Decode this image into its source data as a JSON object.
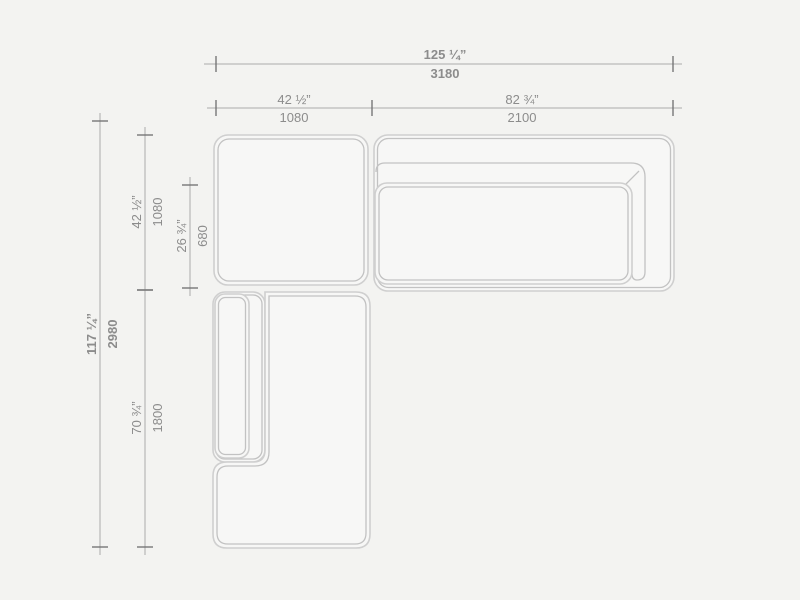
{
  "colors": {
    "background": "#f3f3f1",
    "shape_fill": "#f7f7f6",
    "outline_outer": "#cfcfcf",
    "outline_inner": "#c2c2c2",
    "dim_line": "#ababab",
    "dim_tick": "#6e6e6e",
    "dim_text": "#8c8c8c"
  },
  "dimensions": {
    "total_width": {
      "inches": "125 ¼”",
      "mm": "3180"
    },
    "left_width": {
      "inches": "42 ½”",
      "mm": "1080"
    },
    "right_width": {
      "inches": "82 ¾”",
      "mm": "2100"
    },
    "total_height": {
      "inches": "117 ¼”",
      "mm": "2980"
    },
    "upper_left_height": {
      "inches": "42 ½”",
      "mm": "1080"
    },
    "seat_depth": {
      "inches": "26 ¾”",
      "mm": "680"
    },
    "lower_left_height": {
      "inches": "70 ¾”",
      "mm": "1800"
    }
  }
}
